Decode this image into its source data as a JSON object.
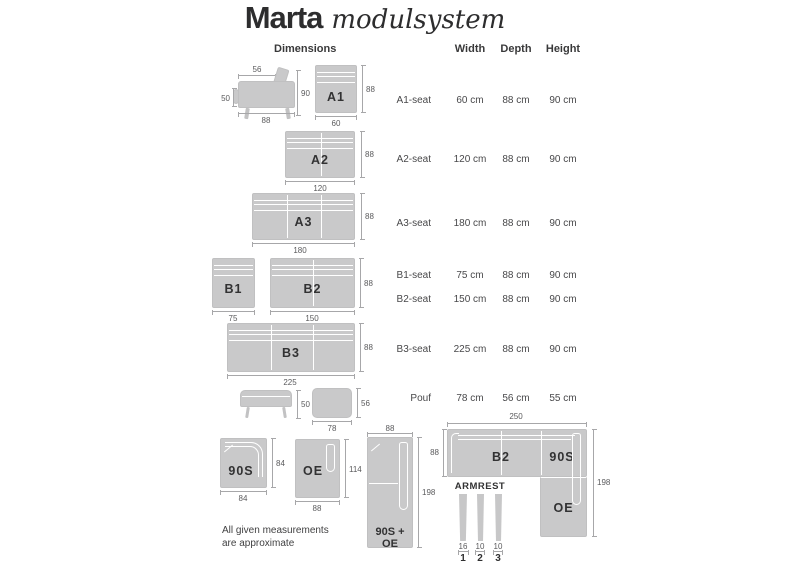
{
  "title": {
    "brand": "Marta",
    "suffix": "modulsystem"
  },
  "columns": {
    "dimensions": "Dimensions",
    "width": "Width",
    "depth": "Depth",
    "height": "Height"
  },
  "table": {
    "rows": [
      {
        "label": "A1-seat",
        "width": "60 cm",
        "depth": "88 cm",
        "height": "90 cm"
      },
      {
        "label": "A2-seat",
        "width": "120 cm",
        "depth": "88 cm",
        "height": "90 cm"
      },
      {
        "label": "A3-seat",
        "width": "180 cm",
        "depth": "88 cm",
        "height": "90 cm"
      },
      {
        "label": "B1-seat",
        "width": "75 cm",
        "depth": "88 cm",
        "height": "90 cm"
      },
      {
        "label": "B2-seat",
        "width": "150 cm",
        "depth": "88 cm",
        "height": "90 cm"
      },
      {
        "label": "B3-seat",
        "width": "225 cm",
        "depth": "88 cm",
        "height": "90 cm"
      },
      {
        "label": "Pouf",
        "width": "78 cm",
        "depth": "56 cm",
        "height": "55 cm"
      }
    ]
  },
  "modules": {
    "a1_side": {
      "top": "56",
      "left": "50",
      "right": "90",
      "bottom": "88"
    },
    "a1": {
      "label": "A1",
      "right": "88",
      "bottom": "60"
    },
    "a2": {
      "label": "A2",
      "right": "88",
      "bottom": "120"
    },
    "a3": {
      "label": "A3",
      "right": "88",
      "bottom": "180"
    },
    "b1": {
      "label": "B1",
      "bottom": "75"
    },
    "b2": {
      "label": "B2",
      "right": "88",
      "bottom": "150"
    },
    "b3": {
      "label": "B3",
      "right": "88",
      "bottom": "225"
    },
    "pouf_side": {
      "right": "50"
    },
    "pouf": {
      "right": "56",
      "bottom": "78"
    },
    "s90": {
      "label": "90S",
      "right": "84",
      "bottom": "84"
    },
    "oe": {
      "label": "OE",
      "right": "114",
      "bottom": "88"
    },
    "s90oe": {
      "label": "90S + OE",
      "top": "88",
      "right": "198"
    },
    "corner": {
      "top": "250",
      "left": "88",
      "right": "198",
      "label_b2": "B2",
      "label_90s": "90S",
      "label_oe": "OE"
    }
  },
  "armrest": {
    "title": "ARMREST",
    "items": [
      {
        "size": "16",
        "index": "1"
      },
      {
        "size": "10",
        "index": "2"
      },
      {
        "size": "10",
        "index": "3"
      }
    ]
  },
  "note": {
    "line1": "All given measurements",
    "line2": "are approximate"
  },
  "colors": {
    "module_fill": "#c9c9ca",
    "seam": "#ffffff",
    "dim_line": "#a7a7a9",
    "dim_text": "#5a5a5c",
    "label_text": "#323233"
  }
}
